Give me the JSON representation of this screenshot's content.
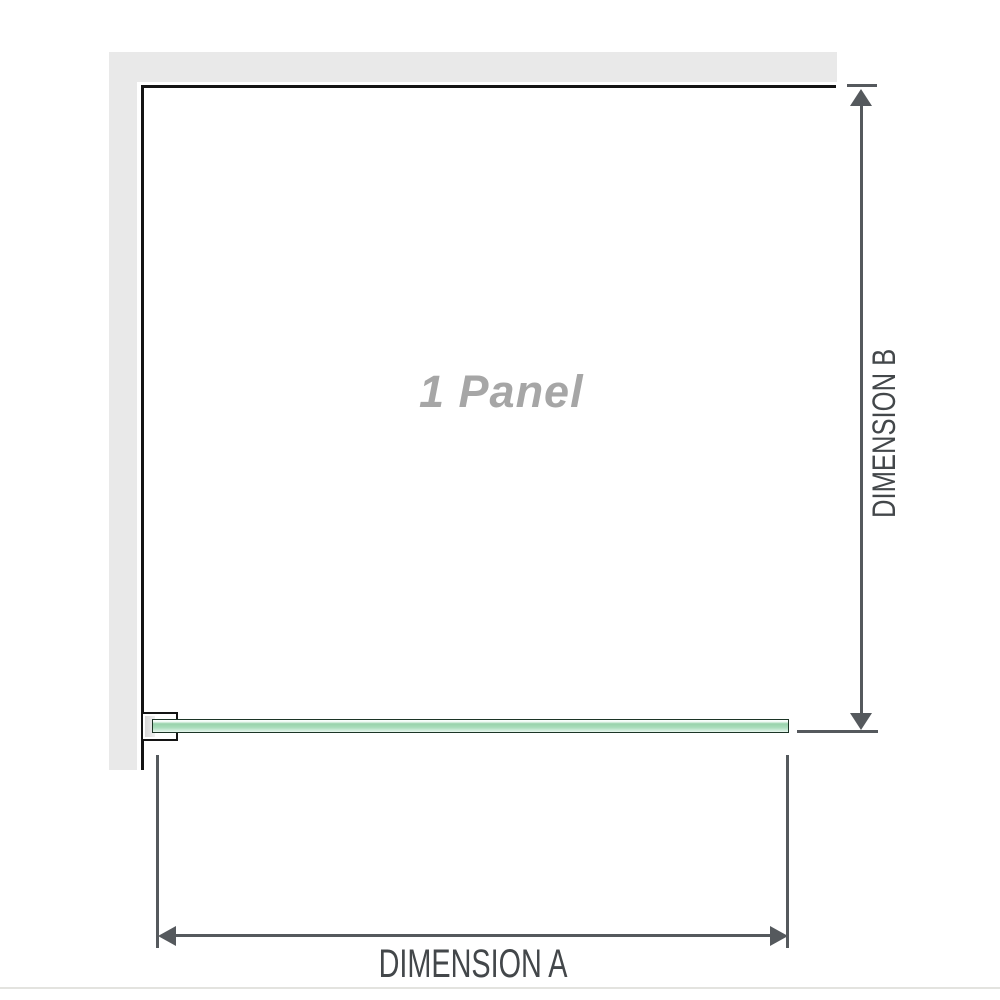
{
  "diagram_title": "1 Panel shower screen dimension diagram",
  "panel": {
    "label": "1 Panel"
  },
  "dimensions": {
    "a": {
      "label": "DIMENSION A",
      "orientation": "horizontal"
    },
    "b": {
      "label": "DIMENSION B",
      "orientation": "vertical"
    }
  },
  "colors": {
    "wall_fill": "#e9e9e9",
    "outline": "#141414",
    "dimension_line": "#55595d",
    "dimension_text": "#43474a",
    "panel_text": "#a6a6a6",
    "glass_fill_mid": "#98d3ac",
    "glass_fill_light": "#e9f7ef",
    "glass_edge": "#1c3526",
    "bottom_rule": "#e3e3df"
  }
}
